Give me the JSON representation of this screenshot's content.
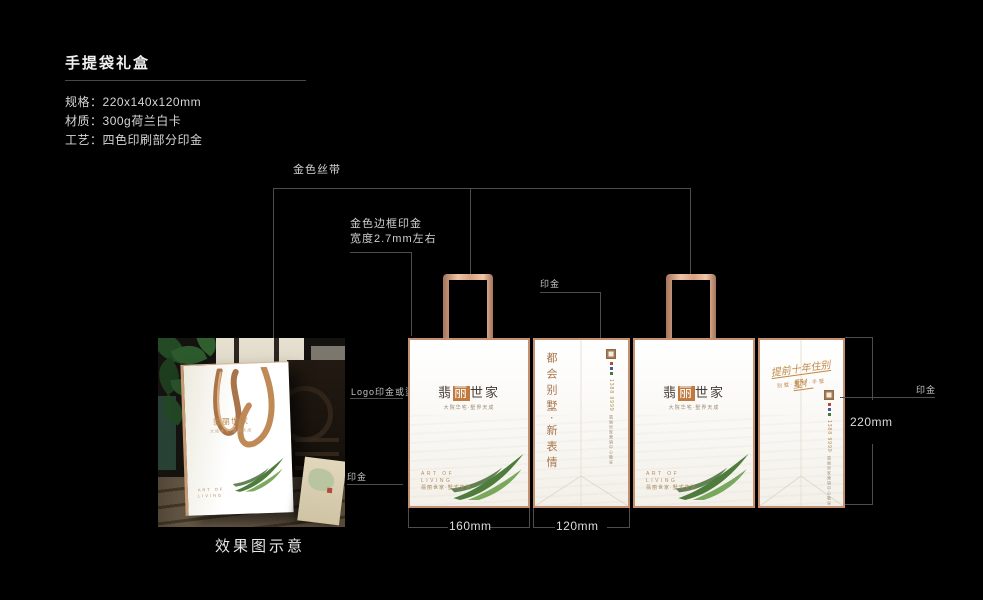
{
  "header": {
    "title": "手提袋礼盒"
  },
  "specs": [
    {
      "label": "规格：",
      "value": "220x140x120mm"
    },
    {
      "label": "材质：",
      "value": "300g荷兰白卡"
    },
    {
      "label": "工艺：",
      "value": "四色印刷部分印金"
    }
  ],
  "annotations": {
    "gold_ribbon": "金色丝带",
    "gold_border_line1": "金色边框印金",
    "gold_border_line2": "宽度2.7mm左右",
    "gilding_top": "印金",
    "logo_gilding": "Logo印金或烫金",
    "gilding_left": "印金",
    "gilding_right": "印金"
  },
  "dimensions": {
    "front_width": "160mm",
    "side_width": "120mm",
    "height": "220mm"
  },
  "caption": "效果图示意",
  "bag": {
    "logo_char1": "翡",
    "logo_char2": "丽",
    "logo_rest": "世家",
    "logo_full": "翡丽世家",
    "tagline": "大院华宅·墅界天成",
    "footer_line1": "ART OF",
    "footer_line2": "LIVING",
    "footer_line3": "翡丽世家·墅式生活"
  },
  "side_panel": {
    "vertical_text": "都会别墅·新表情",
    "phone": "1388 9999",
    "address_note": "翡丽世家营销中心敬呈"
  },
  "side_panel2": {
    "script": "提前十年住别墅！",
    "script_sub": "别墅·叠墅·平墅",
    "phone": "1388 9999",
    "address_note": "翡丽世家营销中心敬呈"
  },
  "colors": {
    "copper": "#c9926e",
    "copper_light": "#eec4a4",
    "gold_text": "#b07d4a",
    "panel_bg": "#f9f7f2",
    "annotation_line": "#4d4d4d",
    "leaf_green": "#55813f",
    "background": "#000000"
  }
}
